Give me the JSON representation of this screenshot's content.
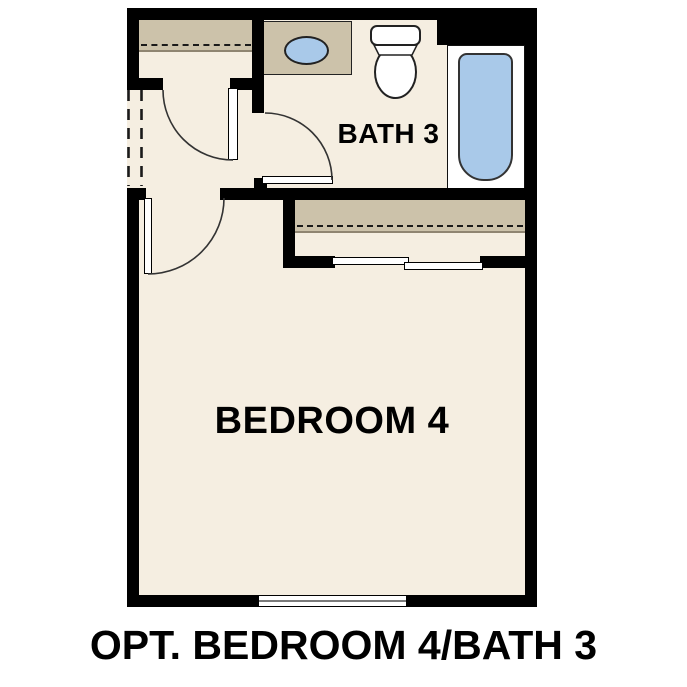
{
  "caption": "OPT. BEDROOM 4/BATH 3",
  "rooms": {
    "bedroom": {
      "label": "BEDROOM 4"
    },
    "bathroom": {
      "label": "BATH 3"
    }
  },
  "fixtures": [
    {
      "name": "vanity-sink"
    },
    {
      "name": "toilet"
    },
    {
      "name": "bathtub"
    }
  ],
  "features": [
    {
      "name": "hall-closet-shelf-with-rod"
    },
    {
      "name": "bedroom-closet-shelf-with-rod"
    },
    {
      "name": "bedroom-closet-bypass-doors"
    },
    {
      "name": "bedroom-window"
    },
    {
      "name": "optional-wall-dashed-opening"
    },
    {
      "name": "hinged-doors",
      "count": 3
    }
  ],
  "colors": {
    "background": "#ffffff",
    "wall": "#000000",
    "floor": "#f5eee1",
    "cabinet": "#ccc2aa",
    "fixture": "#a9c9e9",
    "outline": "#222222",
    "shelfedge": "#8f8571",
    "windowline": "#7a7a7a"
  }
}
